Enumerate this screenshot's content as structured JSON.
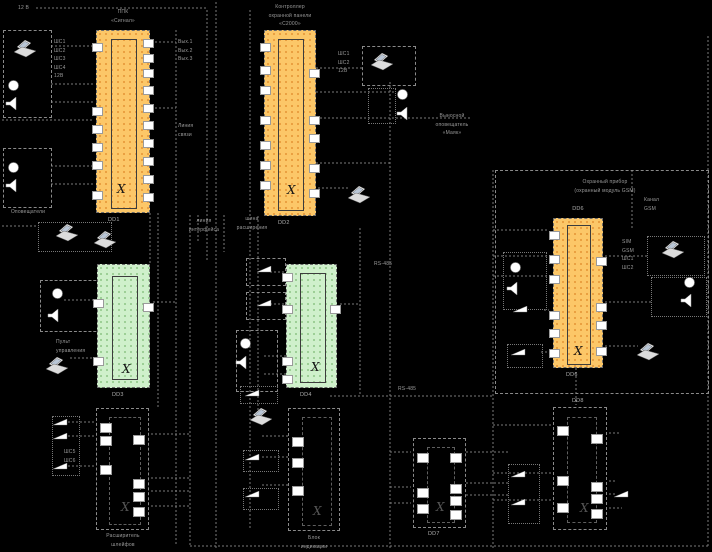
{
  "meta": {
    "type": "security-system-schematic",
    "language": "ru"
  },
  "colors": {
    "background": "#000000",
    "chip_orange": "#fcc768",
    "chip_green": "#cff0cb",
    "pin_fill": "#ffffff",
    "wire": "#7a7a7a",
    "label_text": "#9a9a9a"
  },
  "chips": {
    "crystal_symbol": "Χ",
    "dd1": {
      "designator": "DD1",
      "title_lines": [
        "ППК",
        "«Сигнал»"
      ]
    },
    "dd2": {
      "designator": "DD2",
      "title_lines": [
        "Контроллер",
        "охранной панели",
        "«С2000»"
      ]
    },
    "dd3": {
      "designator": "DD3"
    },
    "dd4": {
      "designator": "DD4"
    },
    "dd6": {
      "designator": "DD6"
    },
    "mod_a": {
      "caption_lines": [
        "Расширитель",
        "шлейфов"
      ]
    },
    "mod_b": {
      "caption_lines": [
        "Блок",
        "индикации"
      ]
    },
    "mod_c": {
      "designator": "DD7"
    },
    "mod_d": {
      "designator": "DD8"
    }
  },
  "labels": {
    "power_top": "12 В",
    "loops_left": [
      "ШС1",
      "ШС2",
      "ШС3",
      "ШС4",
      "12В"
    ],
    "outputs_mid": [
      "Вых.1",
      "Вых.2",
      "Вых.3"
    ],
    "comm_line": [
      "Линия",
      "связи"
    ],
    "annunciators": "Оповещатели",
    "dd2_loops": [
      "ШС1",
      "ШС2",
      "12В"
    ],
    "mayak": [
      "Выносной",
      "оповещатель",
      "«Маяк»"
    ],
    "rs485_mid": "RS-485",
    "bus_a": [
      "линия",
      "интерфейса"
    ],
    "bus_b": [
      "шина",
      "расширения"
    ],
    "control_panel": [
      "Пульт",
      "управления"
    ],
    "gsm_title": [
      "Охранный прибор",
      "(охранный модуль GSM)"
    ],
    "gsm_channel": [
      "Канал",
      "GSM"
    ],
    "gsm_list": [
      "SIM",
      "GSM",
      "ШС1",
      "ШС2"
    ],
    "rs485_bottom": "RS-485",
    "loops_bottom": [
      "ШС5",
      "ШС6"
    ]
  },
  "icon_legend": {
    "laptop-icon": "computer / configurator",
    "led-icon": "indicator lamp",
    "speaker-icon": "sounder",
    "door-contact-icon": "magnetic contact sensor"
  }
}
